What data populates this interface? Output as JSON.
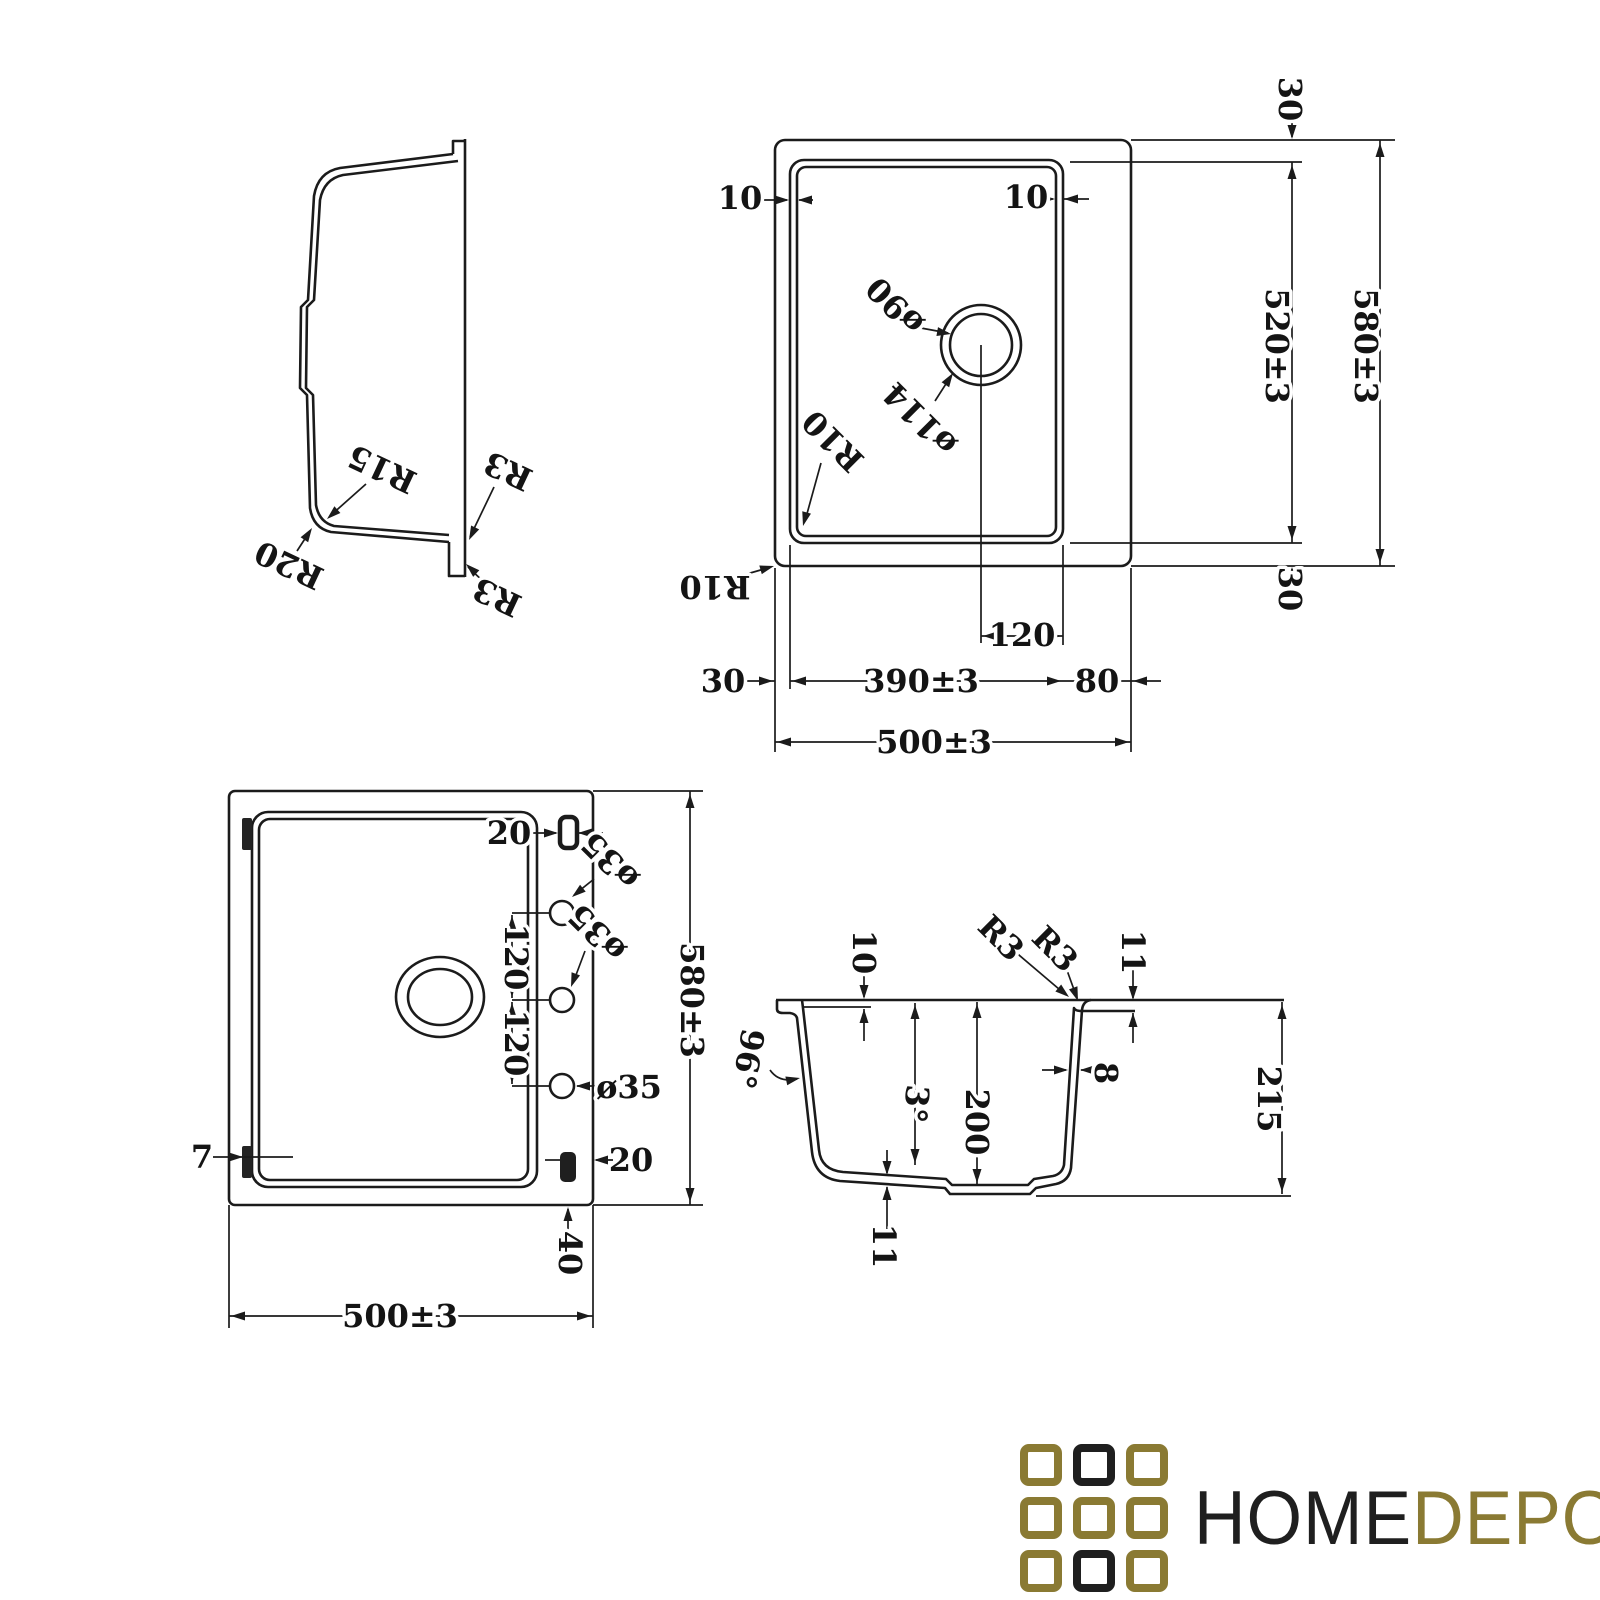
{
  "line_color": "#1b1b1b",
  "views": {
    "side": {
      "labels": {
        "r15": "R15",
        "r20": "R20",
        "r3_top": "R3",
        "r3_bottom": "R3"
      }
    },
    "plan": {
      "labels": {
        "gap_left": "10",
        "gap_right": "10",
        "margin_top": "30",
        "bowl_length": "520±3",
        "overall_length": "580±3",
        "margin_bottom": "30",
        "drain_small": "ø90",
        "drain_large": "ø114",
        "corner_bowl": "R10",
        "corner_outer": "R10",
        "drain_offset": "120",
        "margin_left": "30",
        "bowl_width": "390±3",
        "deck_width": "80",
        "overall_width": "500±3"
      }
    },
    "bottom": {
      "labels": {
        "slot_top": "20",
        "hole_top": "ø35",
        "hole_mid": "ø35",
        "hole_bottom": "ø35",
        "pitch_top": "120",
        "pitch_bottom": "120",
        "tab": "7",
        "slot_bottom": "20",
        "slot_offset": "40",
        "overall_length": "580±3",
        "overall_width": "500±3"
      }
    },
    "section": {
      "labels": {
        "lip": "10",
        "r3_left": "R3",
        "r3_right": "R3",
        "deck_thickness": "11",
        "outer_angle": "96°",
        "draft_angle": "3°",
        "depth": "200",
        "wall": "8",
        "height": "215",
        "bottom_thickness": "11"
      }
    }
  },
  "logo": {
    "home": "HOME",
    "depo": "DEPO",
    "gold": "#8a7a33",
    "dark": "#1f1f1f"
  }
}
